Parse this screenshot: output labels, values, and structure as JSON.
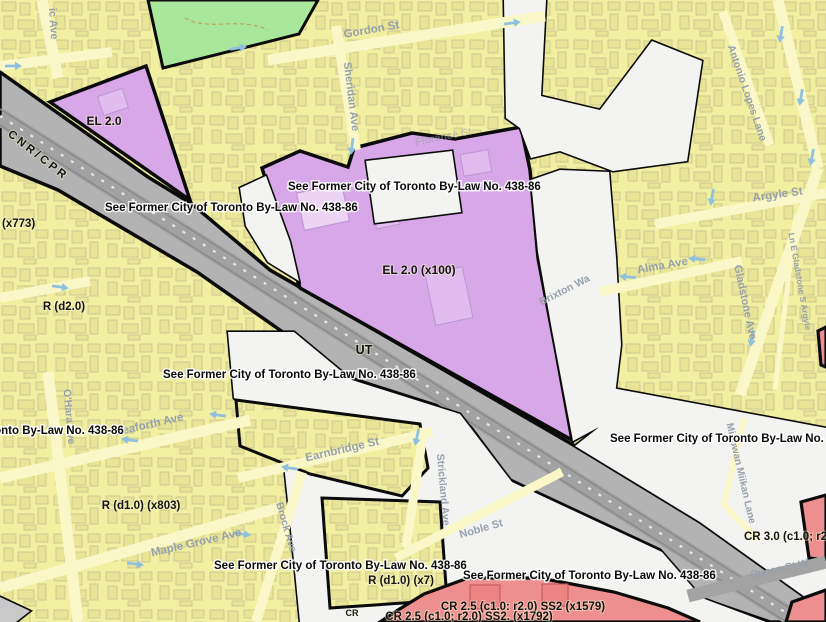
{
  "map": {
    "kind": "zoning-map",
    "colors": {
      "residential_yellow": "#f1efa0",
      "employment_purple": "#d7a7e7",
      "open_space_green": "#a9e79d",
      "rail_corridor_gray": "#b3b3b3",
      "bylaw_hatch_bg": "#f3f3f2",
      "commercial_pink": "#ee8f8f",
      "zone_border_black": "#0b0b0b",
      "street_label_gray_blue": "#97a1ac",
      "arrow_blue": "#8fc0dd"
    },
    "bylaw_note": "See Former City of Toronto By-Law No. 438-86",
    "bylaw_label_positions": [
      {
        "x": 105,
        "y": 211
      },
      {
        "x": 288,
        "y": 190
      },
      {
        "x": 163,
        "y": 378
      },
      {
        "x": -129,
        "y": 434
      },
      {
        "x": 214,
        "y": 569
      },
      {
        "x": 463,
        "y": 579
      },
      {
        "x": 610,
        "y": 442
      }
    ],
    "zone_labels": [
      {
        "id": "x773",
        "text": "(x773)",
        "x": 2,
        "y": 227,
        "size": 11.5,
        "anchor": "start"
      },
      {
        "id": "r-d2-0",
        "text": "R (d2.0)",
        "x": 64,
        "y": 310,
        "size": 11.5
      },
      {
        "id": "el-2-0",
        "text": "EL 2.0",
        "x": 104,
        "y": 125,
        "size": 12
      },
      {
        "id": "el-2-0-x100",
        "text": "EL 2.0 (x100)",
        "x": 419,
        "y": 274,
        "size": 12
      },
      {
        "id": "ut",
        "text": "UT",
        "x": 364,
        "y": 354,
        "size": 12.5
      },
      {
        "id": "r-d1-0-x803",
        "text": "R (d1.0) (x803)",
        "x": 141,
        "y": 509,
        "size": 11.5
      },
      {
        "id": "r-d1-0-x7",
        "text": "R (d1.0) (x7)",
        "x": 401,
        "y": 584,
        "size": 11.5
      },
      {
        "id": "cr-2-5-x1579",
        "text": "CR 2.5 (c1.0: r2.0) SS2 (x1579)",
        "x": 523,
        "y": 610,
        "size": 11.5
      },
      {
        "id": "cr-2-5-x1792",
        "text": "CR 2.5 (c1.0; r2.0) SS2. (x1792)",
        "x": 469,
        "y": 620,
        "size": 11.5
      },
      {
        "id": "cr-fragment",
        "text": "CR",
        "x": 352,
        "y": 616,
        "size": 9
      },
      {
        "id": "cr-3-0",
        "text": "CR 3.0 (c1.0; r2",
        "x": 744,
        "y": 540,
        "size": 11.5,
        "anchor": "start"
      },
      {
        "id": "cnr-cpr",
        "text": "CNR/CPR",
        "x": 36,
        "y": 158,
        "size": 11.5,
        "rot": 38,
        "fill": "#4d4d4d",
        "spacing": 3
      }
    ],
    "street_labels": [
      {
        "id": "ic-ave",
        "text": "ic Ave",
        "x": 50,
        "y": 24,
        "rot": 86,
        "size": 11
      },
      {
        "id": "gordon-st",
        "text": "Gordon St",
        "x": 372,
        "y": 33,
        "rot": -10,
        "size": 11.5
      },
      {
        "id": "sheridan-ave",
        "text": "Sheridan Ave",
        "x": 348,
        "y": 97,
        "rot": 83,
        "size": 11
      },
      {
        "id": "antonio-lopes-lane",
        "text": "Antonio Lopes Lane",
        "x": 744,
        "y": 94,
        "rot": 71,
        "size": 10.5
      },
      {
        "id": "florence-st",
        "text": "Florence St",
        "x": 444,
        "y": 140,
        "rot": -11,
        "size": 10.5,
        "opacity": 0.5
      },
      {
        "id": "argyle-st",
        "text": "Argyle St",
        "x": 778,
        "y": 198,
        "rot": -8,
        "size": 11.5
      },
      {
        "id": "alma-ave",
        "text": "Alma Ave",
        "x": 663,
        "y": 269,
        "rot": -10,
        "size": 11.5
      },
      {
        "id": "gladstone-ave",
        "text": "Gladstone Ave",
        "x": 742,
        "y": 303,
        "rot": 78,
        "size": 11
      },
      {
        "id": "ln-e-gladstone-s-argyle",
        "text": "Ln E Gladstone S Argyle",
        "x": 797,
        "y": 282,
        "rot": 80,
        "size": 8.5
      },
      {
        "id": "brixton-wa",
        "text": "Brixton Wa",
        "x": 566,
        "y": 293,
        "rot": -27,
        "size": 10.5
      },
      {
        "id": "ohara-ave",
        "text": "O'Hara Ave",
        "x": 66,
        "y": 417,
        "rot": 85,
        "size": 10.5
      },
      {
        "id": "seaforth-ave",
        "text": "Seaforth Ave",
        "x": 150,
        "y": 428,
        "rot": -13,
        "size": 11.5
      },
      {
        "id": "maple-grove-ave",
        "text": "Maple Grove Ave",
        "x": 197,
        "y": 546,
        "rot": -13,
        "size": 11.5
      },
      {
        "id": "earnbridge-st",
        "text": "Earnbridge St",
        "x": 343,
        "y": 453,
        "rot": -13,
        "size": 11.5
      },
      {
        "id": "brock-ave",
        "text": "Brock Ave",
        "x": 283,
        "y": 528,
        "rot": 74,
        "size": 10.5
      },
      {
        "id": "strickland-ave",
        "text": "Strickland Ave",
        "x": 440,
        "y": 490,
        "rot": 85,
        "size": 10.5
      },
      {
        "id": "noble-st",
        "text": "Noble St",
        "x": 482,
        "y": 532,
        "rot": -16,
        "size": 11
      },
      {
        "id": "minowan-miikan-lane",
        "text": "Minowan Miikan Lane",
        "x": 738,
        "y": 474,
        "rot": 77,
        "size": 10
      },
      {
        "id": "queen-st-w",
        "text": "Queen St W",
        "x": 780,
        "y": 572,
        "rot": -12,
        "size": 10.5,
        "fill": "#5f6468"
      }
    ],
    "direction_arrows": [
      {
        "x": 13,
        "y": 66,
        "a": 0
      },
      {
        "x": 60,
        "y": 287,
        "a": 8
      },
      {
        "x": 238,
        "y": 48,
        "a": -9
      },
      {
        "x": 512,
        "y": 23,
        "a": -8
      },
      {
        "x": 352,
        "y": 146,
        "a": 97
      },
      {
        "x": 781,
        "y": 34,
        "a": 100
      },
      {
        "x": 801,
        "y": 97,
        "a": 100
      },
      {
        "x": 812,
        "y": 157,
        "a": 100
      },
      {
        "x": 712,
        "y": 197,
        "a": 100
      },
      {
        "x": 628,
        "y": 277,
        "a": 185
      },
      {
        "x": 697,
        "y": 259,
        "a": 185
      },
      {
        "x": 752,
        "y": 338,
        "a": 100
      },
      {
        "x": 218,
        "y": 415,
        "a": 188
      },
      {
        "x": 130,
        "y": 440,
        "a": 188
      },
      {
        "x": 242,
        "y": 534,
        "a": 8
      },
      {
        "x": 135,
        "y": 564,
        "a": 8
      },
      {
        "x": 290,
        "y": 468,
        "a": 188
      },
      {
        "x": 417,
        "y": 437,
        "a": 102
      }
    ]
  }
}
